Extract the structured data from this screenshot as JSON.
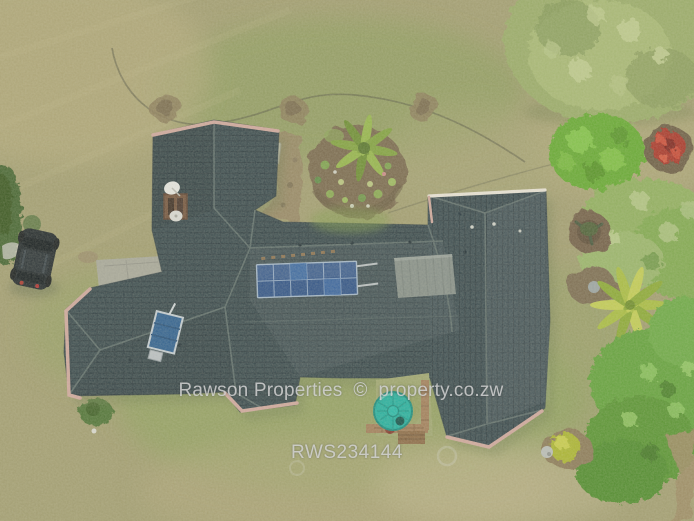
{
  "watermark": {
    "line1": "Rawson Properties  ©  property.co.zw",
    "line2": "RWS234144",
    "text_color": "#d8d8d8"
  },
  "scene": {
    "type": "aerial-drone-photo",
    "subject": "Top-down drone view of a single-storey house with dark tiled hip roof, rooftop solar panels, solar water heater, lawn, circular garden beds, trees, a teal water tank in a small courtyard and a black car parked on the grass",
    "colors": {
      "lawn_base": "#a19c6f",
      "lawn_green": "#85a154",
      "roof_tiles": "#35464b",
      "ridge_capping_pink": "#cfa69c",
      "ridge_capping_white": "#e9e3d7",
      "solar_panel_blue": "#2b4f86",
      "heater_panel_gray": "#8a928c",
      "water_tank_teal": "#1fae9e",
      "soil_brown": "#77664c",
      "foliage_green": "#61a038",
      "patio_gray": "#a6a69c",
      "car_black": "#1d2428",
      "brick_wall_tan": "#a07c58"
    },
    "objects": [
      "house-roof",
      "solar-panel-array",
      "solar-water-heater",
      "satellite-dish",
      "chimney",
      "water-tank",
      "parked-car",
      "circular-garden-bed",
      "palm-tree",
      "tree-canopy",
      "shrubs",
      "red-flower-bush",
      "yellow-bush",
      "courtyard-lawn",
      "brick-wall",
      "patio",
      "garden-hose",
      "dirt-patches"
    ]
  }
}
